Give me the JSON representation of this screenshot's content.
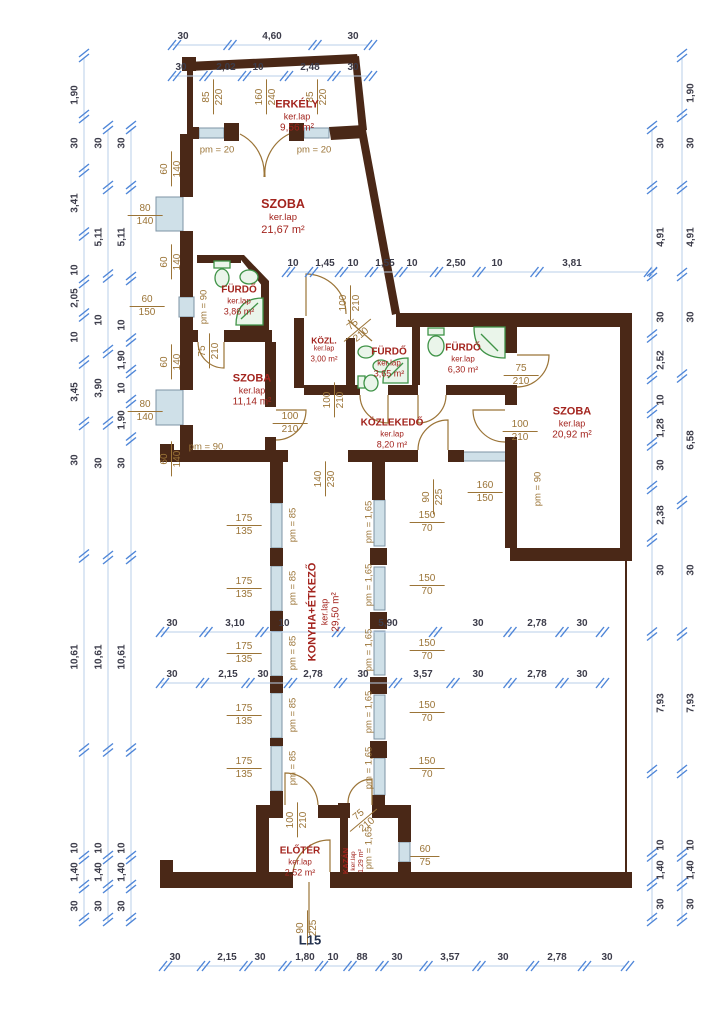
{
  "plan_code": "L15",
  "labels": {
    "finish": "ker.lap"
  },
  "colors": {
    "wall": "#4a2817",
    "room_label": "#a3241e",
    "dim_text": "#3c3c4a",
    "dim_line": "#b9cfe9",
    "tick": "#4f86d8",
    "opening_text": "#9b7437",
    "window_fill": "#cfe0e8",
    "window_stroke": "#7d93a5",
    "fixture": "#3f9347",
    "fixture_fill": "#eaf5ea",
    "plan_code": "#22304d"
  },
  "rooms": [
    {
      "name": "ERKÉLY",
      "area": "9,56 m²",
      "x": 297,
      "y": 117,
      "rot": 0,
      "size": "md"
    },
    {
      "name": "SZOBA",
      "area": "21,67 m²",
      "x": 283,
      "y": 217,
      "rot": 0,
      "size": "lg"
    },
    {
      "name": "FÜRDŐ",
      "area": "3,86 m²",
      "x": 239,
      "y": 301,
      "rot": 0,
      "size": "sm"
    },
    {
      "name": "KÖZL.",
      "area": "3,00 m²",
      "x": 324,
      "y": 350,
      "rot": 0,
      "size": "xs"
    },
    {
      "name": "FÜRDŐ",
      "area": "3,65 m²",
      "x": 389,
      "y": 363,
      "rot": 0,
      "size": "sm"
    },
    {
      "name": "FÜRDŐ",
      "area": "6,30 m²",
      "x": 463,
      "y": 359,
      "rot": 0,
      "size": "sm"
    },
    {
      "name": "SZOBA",
      "area": "11,14 m²",
      "x": 252,
      "y": 391,
      "rot": 0,
      "size": "md"
    },
    {
      "name": "SZOBA",
      "area": "20,92 m²",
      "x": 572,
      "y": 424,
      "rot": 0,
      "size": "md"
    },
    {
      "name": "KÖZLEKEDŐ",
      "area": "8,20 m²",
      "x": 392,
      "y": 434,
      "rot": 0,
      "size": "sm"
    },
    {
      "name": "KONYHA+ÉTKEZŐ",
      "area": "29,50 m²",
      "x": 325,
      "y": 612,
      "rot": -90,
      "size": "md"
    },
    {
      "name": "ELŐTÉR",
      "area": "2,52 m²",
      "x": 300,
      "y": 862,
      "rot": 0,
      "size": "sm"
    },
    {
      "name": "KAZÁN",
      "area": "1,29 m²",
      "x": 354,
      "y": 861,
      "rot": -90,
      "size": "xxs"
    }
  ],
  "dim_chains": [
    {
      "o": "h",
      "y": 45,
      "x1": 172,
      "x2": 368,
      "items": [
        {
          "v": "30",
          "at": 183
        },
        {
          "v": "4,60",
          "at": 272
        },
        {
          "v": "30",
          "at": 353
        }
      ]
    },
    {
      "o": "h",
      "y": 76,
      "x1": 172,
      "x2": 368,
      "items": [
        {
          "v": "30",
          "at": 181
        },
        {
          "v": "2,02",
          "at": 226
        },
        {
          "v": "10",
          "at": 258
        },
        {
          "v": "2,48",
          "at": 310
        },
        {
          "v": "30",
          "at": 353
        }
      ]
    },
    {
      "o": "h",
      "y": 272,
      "x1": 286,
      "x2": 648,
      "items": [
        {
          "v": "10",
          "at": 293
        },
        {
          "v": "1,45",
          "at": 325
        },
        {
          "v": "10",
          "at": 353
        },
        {
          "v": "1,55",
          "at": 385
        },
        {
          "v": "10",
          "at": 412
        },
        {
          "v": "2,50",
          "at": 456
        },
        {
          "v": "10",
          "at": 497
        },
        {
          "v": "3,81",
          "at": 572
        }
      ]
    },
    {
      "o": "h",
      "y": 632,
      "x1": 160,
      "x2": 600,
      "items": [
        {
          "v": "30",
          "at": 172
        },
        {
          "v": "3,10",
          "at": 235
        },
        {
          "v": "10",
          "at": 284
        },
        {
          "v": "5,90",
          "at": 388
        },
        {
          "v": "30",
          "at": 478
        },
        {
          "v": "2,78",
          "at": 537
        },
        {
          "v": "30",
          "at": 582
        }
      ]
    },
    {
      "o": "h",
      "y": 683,
      "x1": 160,
      "x2": 600,
      "items": [
        {
          "v": "30",
          "at": 172
        },
        {
          "v": "2,15",
          "at": 228
        },
        {
          "v": "30",
          "at": 263
        },
        {
          "v": "2,78",
          "at": 313
        },
        {
          "v": "30",
          "at": 363
        },
        {
          "v": "3,57",
          "at": 423
        },
        {
          "v": "30",
          "at": 478
        },
        {
          "v": "2,78",
          "at": 537
        },
        {
          "v": "30",
          "at": 582
        }
      ]
    },
    {
      "o": "h",
      "y": 966,
      "x1": 163,
      "x2": 625,
      "items": [
        {
          "v": "30",
          "at": 175
        },
        {
          "v": "2,15",
          "at": 227
        },
        {
          "v": "30",
          "at": 260
        },
        {
          "v": "1,80",
          "at": 305
        },
        {
          "v": "10",
          "at": 333
        },
        {
          "v": "88",
          "at": 362
        },
        {
          "v": "30",
          "at": 397
        },
        {
          "v": "3,57",
          "at": 450
        },
        {
          "v": "30",
          "at": 503
        },
        {
          "v": "2,78",
          "at": 557
        },
        {
          "v": "30",
          "at": 607
        }
      ]
    },
    {
      "o": "v",
      "x": 84,
      "y1": 58,
      "y2": 922,
      "side": -1,
      "items": [
        {
          "v": "1,90",
          "at": 95
        },
        {
          "v": "30",
          "at": 143
        },
        {
          "v": "3,41",
          "at": 203
        },
        {
          "v": "10",
          "at": 270
        },
        {
          "v": "2,05",
          "at": 298
        },
        {
          "v": "10",
          "at": 337
        },
        {
          "v": "3,45",
          "at": 392
        },
        {
          "v": "30",
          "at": 460
        },
        {
          "v": "10,61",
          "at": 657
        },
        {
          "v": "10",
          "at": 848
        },
        {
          "v": "1,40",
          "at": 872
        },
        {
          "v": "30",
          "at": 906
        }
      ]
    },
    {
      "o": "v",
      "x": 108,
      "y1": 130,
      "y2": 922,
      "side": -1,
      "items": [
        {
          "v": "30",
          "at": 143
        },
        {
          "v": "5,11",
          "at": 237
        },
        {
          "v": "10",
          "at": 320
        },
        {
          "v": "3,90",
          "at": 388
        },
        {
          "v": "30",
          "at": 463
        },
        {
          "v": "10,61",
          "at": 657
        },
        {
          "v": "10",
          "at": 848
        },
        {
          "v": "1,40",
          "at": 872
        },
        {
          "v": "30",
          "at": 906
        }
      ]
    },
    {
      "o": "v",
      "x": 131,
      "y1": 130,
      "y2": 922,
      "side": -1,
      "items": [
        {
          "v": "30",
          "at": 143
        },
        {
          "v": "5,11",
          "at": 237
        },
        {
          "v": "10",
          "at": 325
        },
        {
          "v": "1,90",
          "at": 360
        },
        {
          "v": "10",
          "at": 388
        },
        {
          "v": "1,90",
          "at": 420
        },
        {
          "v": "30",
          "at": 463
        },
        {
          "v": "10,61",
          "at": 657
        },
        {
          "v": "10",
          "at": 848
        },
        {
          "v": "1,40",
          "at": 872
        },
        {
          "v": "30",
          "at": 906
        }
      ]
    },
    {
      "o": "v",
      "x": 652,
      "y1": 130,
      "y2": 922,
      "side": 1,
      "items": [
        {
          "v": "30",
          "at": 143
        },
        {
          "v": "4,91",
          "at": 237
        },
        {
          "v": "30",
          "at": 317
        },
        {
          "v": "2,52",
          "at": 360
        },
        {
          "v": "10",
          "at": 400
        },
        {
          "v": "1,28",
          "at": 428
        },
        {
          "v": "30",
          "at": 465
        },
        {
          "v": "2,38",
          "at": 515
        },
        {
          "v": "30",
          "at": 570
        },
        {
          "v": "7,93",
          "at": 703
        },
        {
          "v": "10",
          "at": 845
        },
        {
          "v": "1,40",
          "at": 870
        },
        {
          "v": "30",
          "at": 904
        }
      ]
    },
    {
      "o": "v",
      "x": 682,
      "y1": 58,
      "y2": 922,
      "side": 1,
      "items": [
        {
          "v": "1,90",
          "at": 93
        },
        {
          "v": "30",
          "at": 143
        },
        {
          "v": "4,91",
          "at": 237
        },
        {
          "v": "30",
          "at": 317
        },
        {
          "v": "6,58",
          "at": 440
        },
        {
          "v": "30",
          "at": 570
        },
        {
          "v": "7,93",
          "at": 703
        },
        {
          "v": "10",
          "at": 845
        },
        {
          "v": "1,40",
          "at": 870
        },
        {
          "v": "30",
          "at": 904
        }
      ]
    }
  ],
  "openings": [
    {
      "a": "85",
      "b": "220",
      "x": 213,
      "y": 97,
      "rot": -90
    },
    {
      "a": "160",
      "b": "240",
      "x": 266,
      "y": 97,
      "rot": -90
    },
    {
      "a": "85",
      "b": "220",
      "x": 317,
      "y": 97,
      "rot": -90
    },
    {
      "a": "60",
      "b": "140",
      "x": 171,
      "y": 169,
      "rot": -90
    },
    {
      "a": "80",
      "b": "140",
      "x": 145,
      "y": 215,
      "rot": 0
    },
    {
      "a": "60",
      "b": "140",
      "x": 171,
      "y": 262,
      "rot": -90
    },
    {
      "a": "60",
      "b": "150",
      "x": 147,
      "y": 306,
      "rot": 0
    },
    {
      "a": "75",
      "b": "210",
      "x": 209,
      "y": 351,
      "rot": -90
    },
    {
      "a": "60",
      "b": "140",
      "x": 171,
      "y": 362,
      "rot": -90
    },
    {
      "a": "80",
      "b": "140",
      "x": 145,
      "y": 411,
      "rot": 0
    },
    {
      "a": "60",
      "b": "140",
      "x": 171,
      "y": 459,
      "rot": -90
    },
    {
      "a": "100",
      "b": "210",
      "x": 290,
      "y": 423,
      "rot": 0
    },
    {
      "a": "100",
      "b": "210",
      "x": 350,
      "y": 303,
      "rot": -90
    },
    {
      "a": "75",
      "b": "210",
      "x": 357,
      "y": 330,
      "rot": -40
    },
    {
      "a": "100",
      "b": "210",
      "x": 334,
      "y": 400,
      "rot": -90
    },
    {
      "a": "75",
      "b": "210",
      "x": 521,
      "y": 375,
      "rot": 0
    },
    {
      "a": "100",
      "b": "210",
      "x": 520,
      "y": 431,
      "rot": 0
    },
    {
      "a": "140",
      "b": "230",
      "x": 325,
      "y": 479,
      "rot": -90
    },
    {
      "a": "90",
      "b": "225",
      "x": 433,
      "y": 497,
      "rot": -90
    },
    {
      "a": "160",
      "b": "150",
      "x": 485,
      "y": 492,
      "rot": 0
    },
    {
      "a": "175",
      "b": "135",
      "x": 244,
      "y": 525,
      "rot": 0
    },
    {
      "a": "175",
      "b": "135",
      "x": 244,
      "y": 588,
      "rot": 0
    },
    {
      "a": "175",
      "b": "135",
      "x": 244,
      "y": 653,
      "rot": 0
    },
    {
      "a": "175",
      "b": "135",
      "x": 244,
      "y": 715,
      "rot": 0
    },
    {
      "a": "175",
      "b": "135",
      "x": 244,
      "y": 768,
      "rot": 0
    },
    {
      "a": "150",
      "b": "70",
      "x": 427,
      "y": 522,
      "rot": 0
    },
    {
      "a": "150",
      "b": "70",
      "x": 427,
      "y": 585,
      "rot": 0
    },
    {
      "a": "150",
      "b": "70",
      "x": 427,
      "y": 650,
      "rot": 0
    },
    {
      "a": "150",
      "b": "70",
      "x": 427,
      "y": 712,
      "rot": 0
    },
    {
      "a": "150",
      "b": "70",
      "x": 427,
      "y": 768,
      "rot": 0
    },
    {
      "a": "100",
      "b": "210",
      "x": 297,
      "y": 820,
      "rot": -90
    },
    {
      "a": "75",
      "b": "210",
      "x": 363,
      "y": 820,
      "rot": -40
    },
    {
      "a": "60",
      "b": "75",
      "x": 425,
      "y": 856,
      "rot": 0
    },
    {
      "a": "90",
      "b": "225",
      "x": 307,
      "y": 928,
      "rot": -90
    }
  ],
  "pm_labels": [
    {
      "t": "pm = 20",
      "x": 217,
      "y": 150,
      "rot": 0
    },
    {
      "t": "pm = 20",
      "x": 314,
      "y": 150,
      "rot": 0
    },
    {
      "t": "pm = 90",
      "x": 204,
      "y": 307,
      "rot": -90
    },
    {
      "t": "pm = 90",
      "x": 206,
      "y": 447,
      "rot": 0
    },
    {
      "t": "pm = 90",
      "x": 538,
      "y": 489,
      "rot": -90
    },
    {
      "t": "pm = 85",
      "x": 293,
      "y": 525,
      "rot": -90
    },
    {
      "t": "pm = 85",
      "x": 293,
      "y": 588,
      "rot": -90
    },
    {
      "t": "pm = 85",
      "x": 293,
      "y": 653,
      "rot": -90
    },
    {
      "t": "pm = 85",
      "x": 293,
      "y": 715,
      "rot": -90
    },
    {
      "t": "pm = 85",
      "x": 293,
      "y": 768,
      "rot": -90
    },
    {
      "t": "pm = 1,65",
      "x": 369,
      "y": 522,
      "rot": -90
    },
    {
      "t": "pm = 1,65",
      "x": 369,
      "y": 585,
      "rot": -90
    },
    {
      "t": "pm = 1,65",
      "x": 369,
      "y": 650,
      "rot": -90
    },
    {
      "t": "pm = 1,65",
      "x": 369,
      "y": 712,
      "rot": -90
    },
    {
      "t": "pm = 1,65",
      "x": 369,
      "y": 768,
      "rot": -90
    },
    {
      "t": "pm = 1,65",
      "x": 369,
      "y": 848,
      "rot": -90
    }
  ]
}
